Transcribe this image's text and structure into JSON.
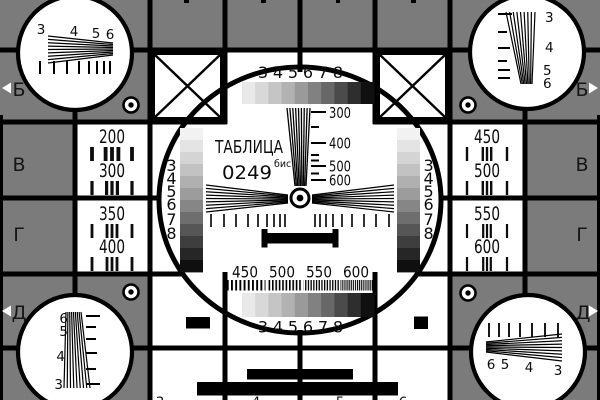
{
  "card": {
    "title": "ТАБЛИЦА",
    "code": "0249",
    "code_superscript": "бис"
  },
  "colors": {
    "background_gray": "#7b7b7b",
    "panel_white": "#ffffff",
    "line_black": "#000000"
  },
  "row_markers": {
    "left": [
      "Б",
      "В",
      "Г",
      "Д"
    ],
    "right": [
      "Б",
      "В",
      "Г",
      "Д"
    ]
  },
  "side_panels": {
    "left": [
      "200",
      "300",
      "350",
      "400"
    ],
    "right": [
      "450",
      "500",
      "550",
      "600"
    ]
  },
  "center": {
    "scale_labels": [
      "300",
      "400",
      "500",
      "600"
    ],
    "frequency_labels": [
      "450",
      "500",
      "550",
      "600"
    ],
    "top_labels": [
      "3",
      "4",
      "5",
      "6",
      "7",
      "8"
    ],
    "bottom_labels": [
      "3",
      "4",
      "5",
      "6",
      "7",
      "8"
    ],
    "left_column_labels": [
      "3",
      "4",
      "5",
      "6",
      "7",
      "8"
    ],
    "right_column_labels": [
      "3",
      "4",
      "5",
      "6",
      "7",
      "8"
    ],
    "top_steps": [
      "#e9e9e9",
      "#d8d8d8",
      "#c5c5c5",
      "#b2b2b2",
      "#9a9a9a",
      "#818181",
      "#686868",
      "#4b4b4b",
      "#2e2e2e",
      "#101010"
    ],
    "bottom_steps": [
      "#e9e9e9",
      "#d8d8d8",
      "#c5c5c5",
      "#b2b2b2",
      "#9a9a9a",
      "#818181",
      "#686868",
      "#4b4b4b",
      "#2e2e2e",
      "#101010"
    ],
    "left_steps": [
      "#f2f2f2",
      "#e4e4e4",
      "#d4d4d4",
      "#c2c2c2",
      "#b0b0b0",
      "#9c9c9c",
      "#868686",
      "#6e6e6e",
      "#565656",
      "#3e3e3e",
      "#262626",
      "#0f0f0f"
    ],
    "right_steps": [
      "#f2f2f2",
      "#e4e4e4",
      "#d4d4d4",
      "#c2c2c2",
      "#b0b0b0",
      "#9c9c9c",
      "#868686",
      "#6e6e6e",
      "#565656",
      "#3e3e3e",
      "#262626",
      "#0f0f0f"
    ]
  },
  "corner_circles": {
    "top_left": [
      "3",
      "4",
      "5",
      "6"
    ],
    "top_right": [
      "3",
      "4",
      "5",
      "6"
    ],
    "bottom_left": [
      "6",
      "5",
      "4",
      "3"
    ],
    "bottom_right": [
      "6",
      "5",
      "4",
      "3"
    ]
  },
  "bottom_edge_labels": [
    "3",
    "4",
    "5",
    "6"
  ]
}
